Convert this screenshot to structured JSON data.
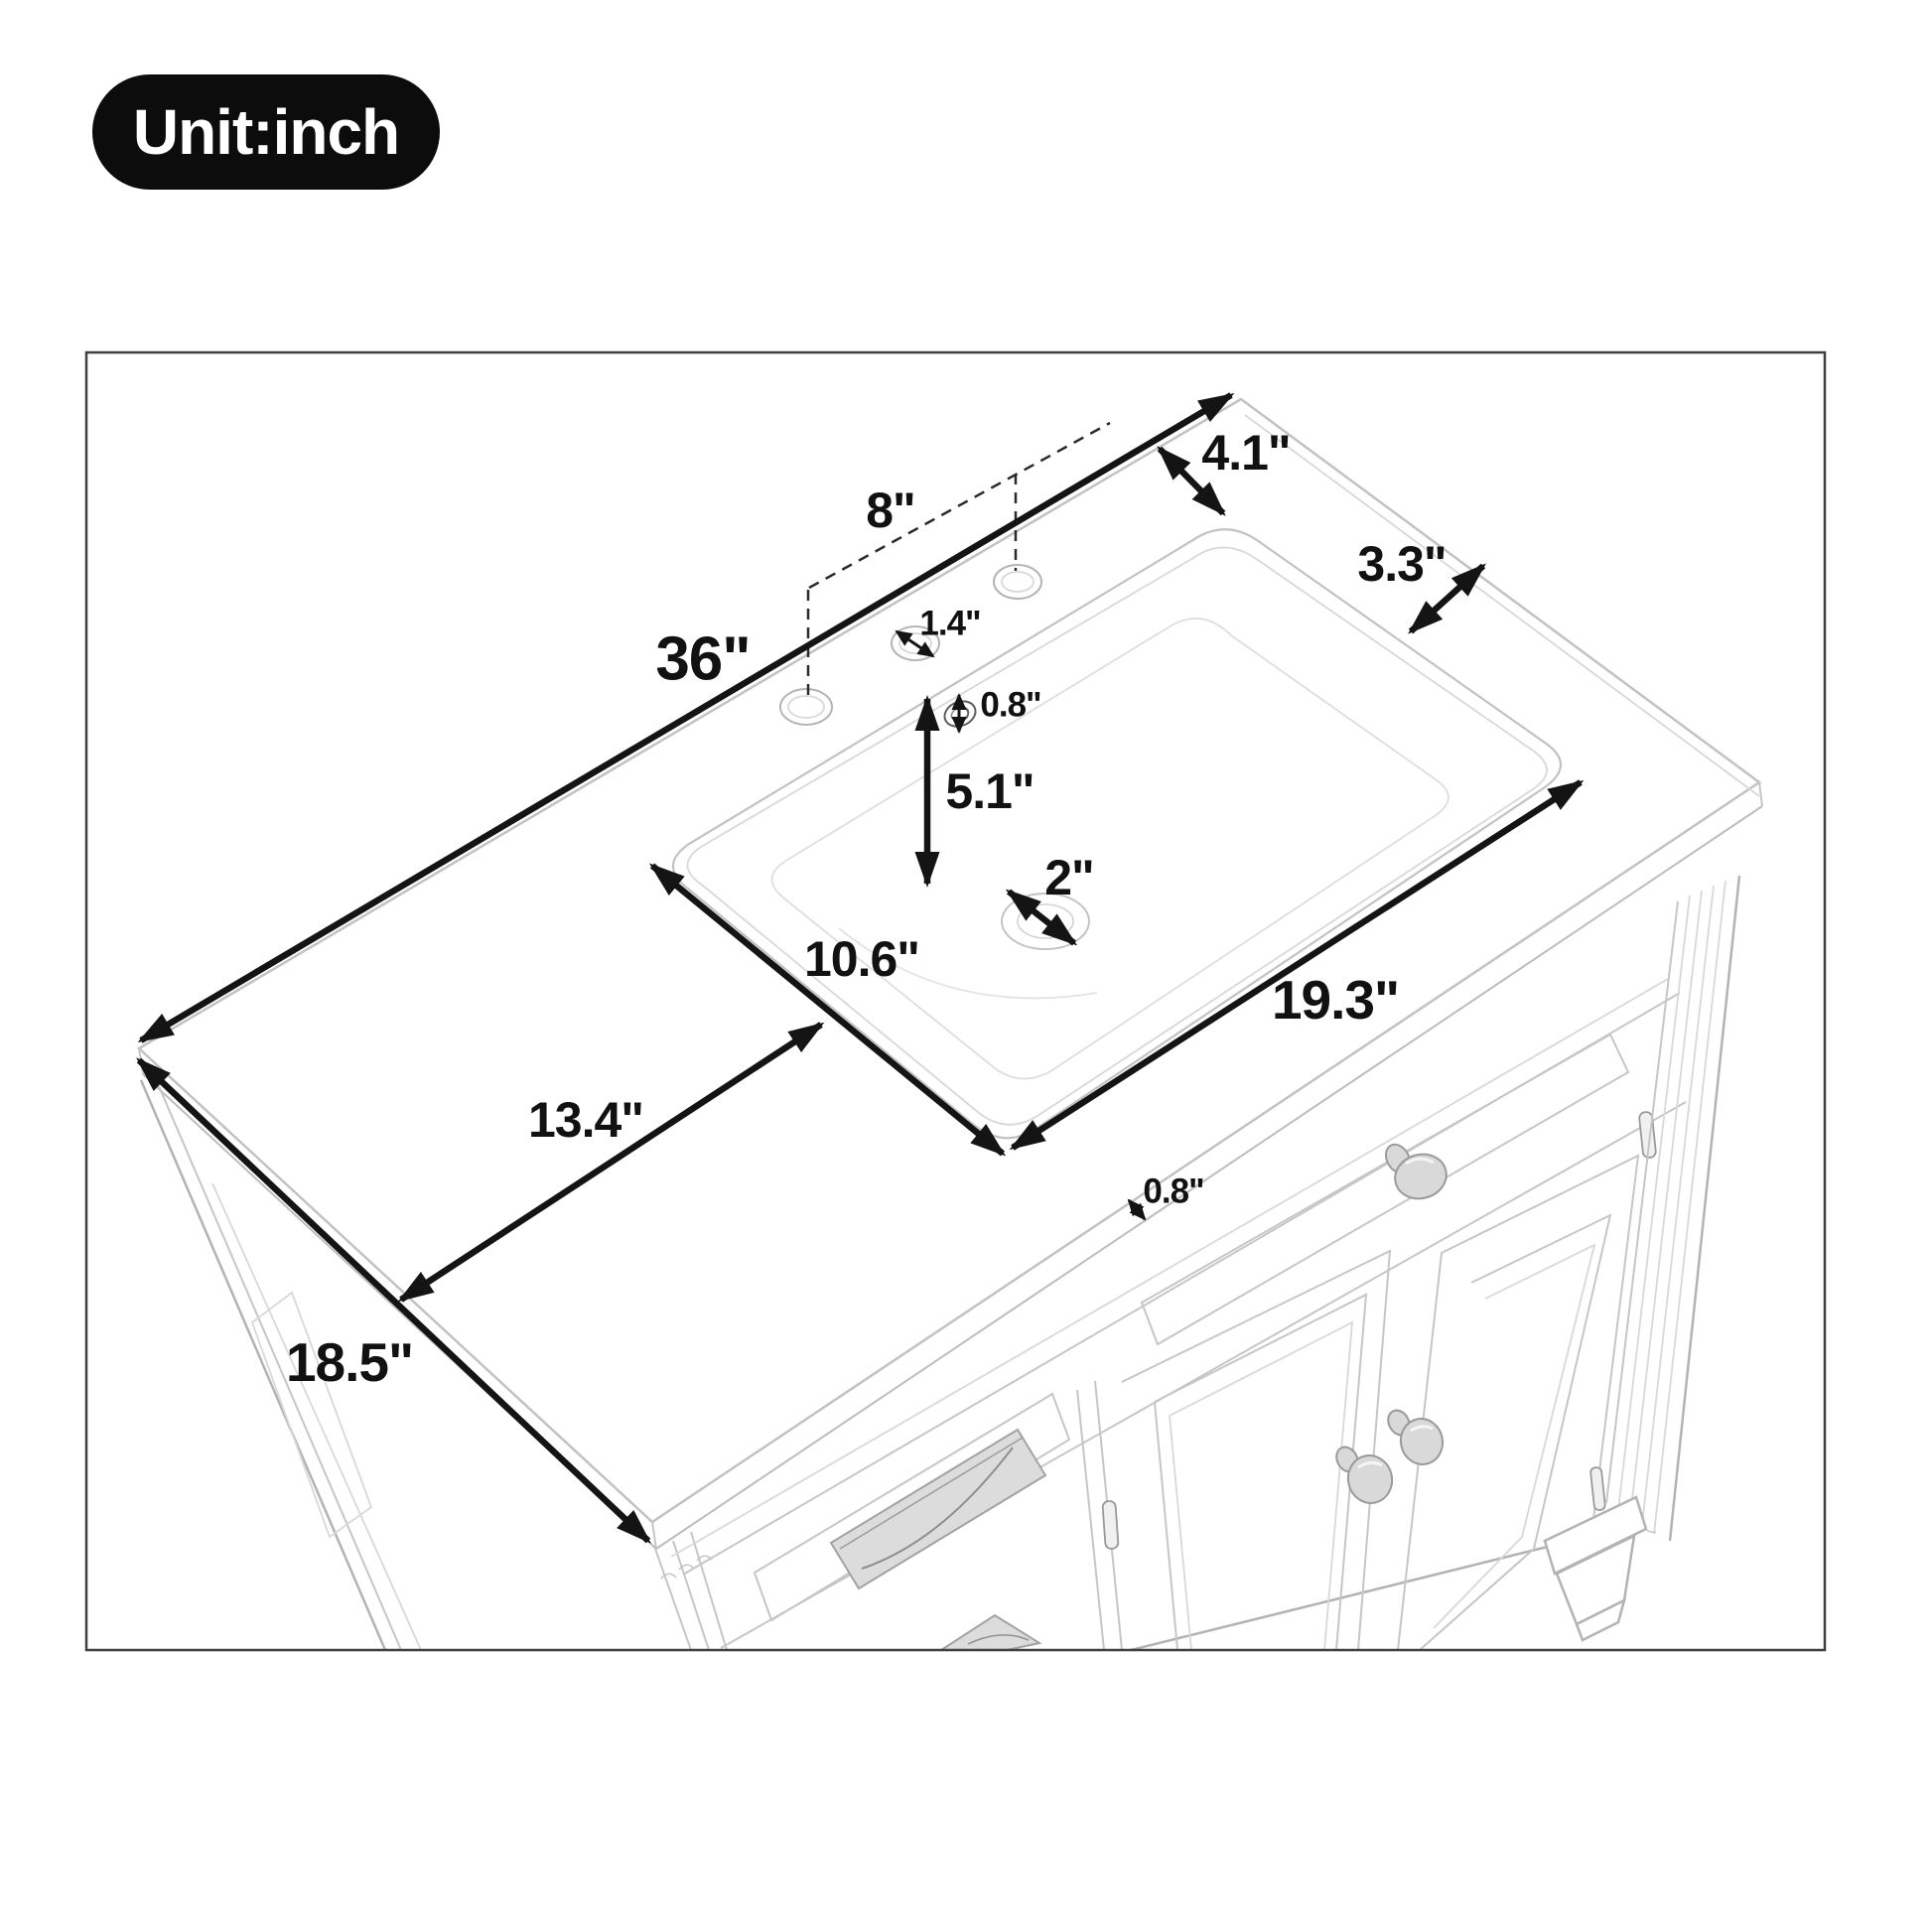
{
  "unit_badge": {
    "label": "Unit:inch"
  },
  "diagram": {
    "subject": "bathroom vanity cabinet with ceramic sink top, perspective dimension drawing",
    "dims": {
      "d36": "36\"",
      "d18_5": "18.5\"",
      "d13_4": "13.4\"",
      "d10_6": "10.6\"",
      "d19_3": "19.3\"",
      "d8": "8\"",
      "d5_1": "5.1\"",
      "d4_1": "4.1\"",
      "d3_3": "3.3\"",
      "d2": "2\"",
      "d1_4": "1.4\"",
      "d0_8_overflow": "0.8\"",
      "d0_8_thickness": "0.8\""
    },
    "colors": {
      "dimension": "#141414",
      "lineart": "#c6c6c6",
      "badge": "#0c0c0c"
    }
  }
}
